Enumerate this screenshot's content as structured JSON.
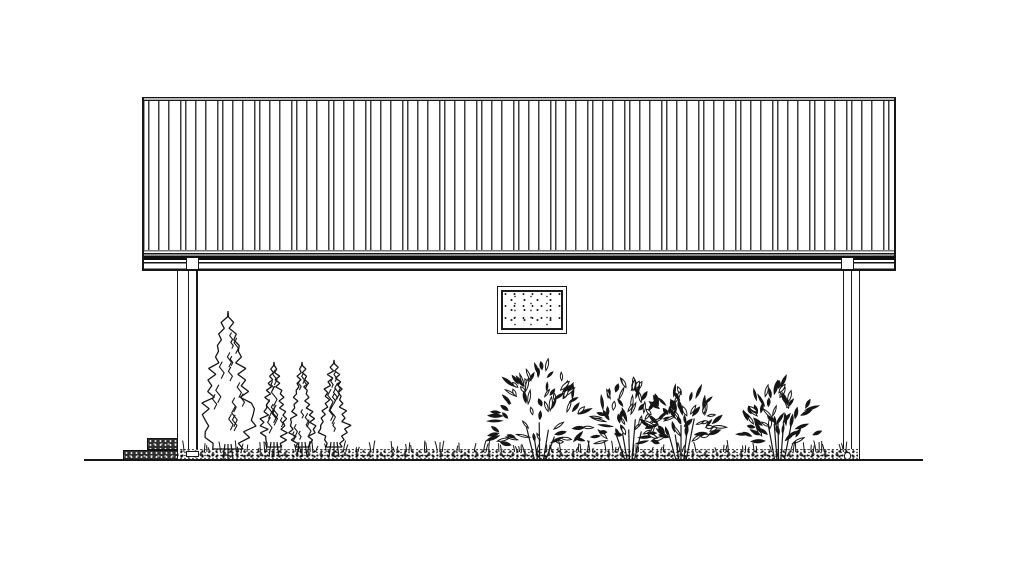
{
  "meta": {
    "drawing_kind": "building-side-elevation-line-drawing",
    "background": "#ffffff",
    "ink": "#161616",
    "panel_seam_color": "#3f3f3f",
    "ridge_cap_fill": "#b6b6b6",
    "seed": 11
  },
  "scene": {
    "roof": {
      "cap": [
        143,
        96.5,
        753,
        4.8
      ],
      "panels": [
        143,
        101.3,
        753,
        148.7
      ],
      "eave": [
        143,
        250,
        753,
        20.5
      ],
      "edge_left": [
        142.3,
        96.5,
        2,
        174
      ],
      "edge_right": [
        894.3,
        96.5,
        2,
        174
      ]
    },
    "wall": {
      "rect": [
        196.5,
        270.5,
        663.5,
        189.5
      ]
    },
    "window": {
      "rect": [
        497,
        286,
        70,
        48
      ]
    },
    "downspouts": {
      "left_trim": [
        177,
        270.5,
        1.3,
        180
      ],
      "left_pipe": [
        188,
        270.5,
        9,
        182
      ],
      "left_bracket": [
        186,
        256.5,
        13,
        13
      ],
      "left_shoe": [
        185.5,
        450.5,
        13,
        6.5
      ],
      "right_pipe": [
        843,
        270.5,
        9,
        182
      ],
      "right_bracket": [
        840.5,
        256.5,
        13,
        13
      ],
      "right_shoe": [
        843.8,
        452,
        7.5,
        7.5
      ]
    },
    "steps": {
      "lower": [
        123,
        449.8,
        55,
        10.7
      ],
      "upper": [
        147,
        437.8,
        31,
        12.2
      ]
    },
    "bed": {
      "rect": [
        178,
        448.5,
        680,
        12.5
      ]
    },
    "ground": {
      "line": [
        84,
        459.3,
        839,
        1.7
      ]
    },
    "trees": [
      {
        "cx": 228,
        "top": 311,
        "base": 452,
        "halfW": 30
      },
      {
        "cx": 274,
        "top": 362,
        "base": 450,
        "halfW": 14
      },
      {
        "cx": 302,
        "top": 362,
        "base": 450,
        "halfW": 13
      },
      {
        "cx": 334,
        "top": 360,
        "base": 450,
        "halfW": 16
      }
    ],
    "bushes": [
      {
        "cx": 540,
        "top": 366,
        "base": 452,
        "rx": 47
      },
      {
        "cx": 630,
        "top": 386,
        "base": 451,
        "rx": 40
      },
      {
        "cx": 681,
        "top": 384,
        "base": 451,
        "rx": 37
      },
      {
        "cx": 779,
        "top": 386,
        "base": 452,
        "rx": 37
      }
    ],
    "grass": {
      "from": 184,
      "to": 852,
      "baseY": 450
    }
  }
}
